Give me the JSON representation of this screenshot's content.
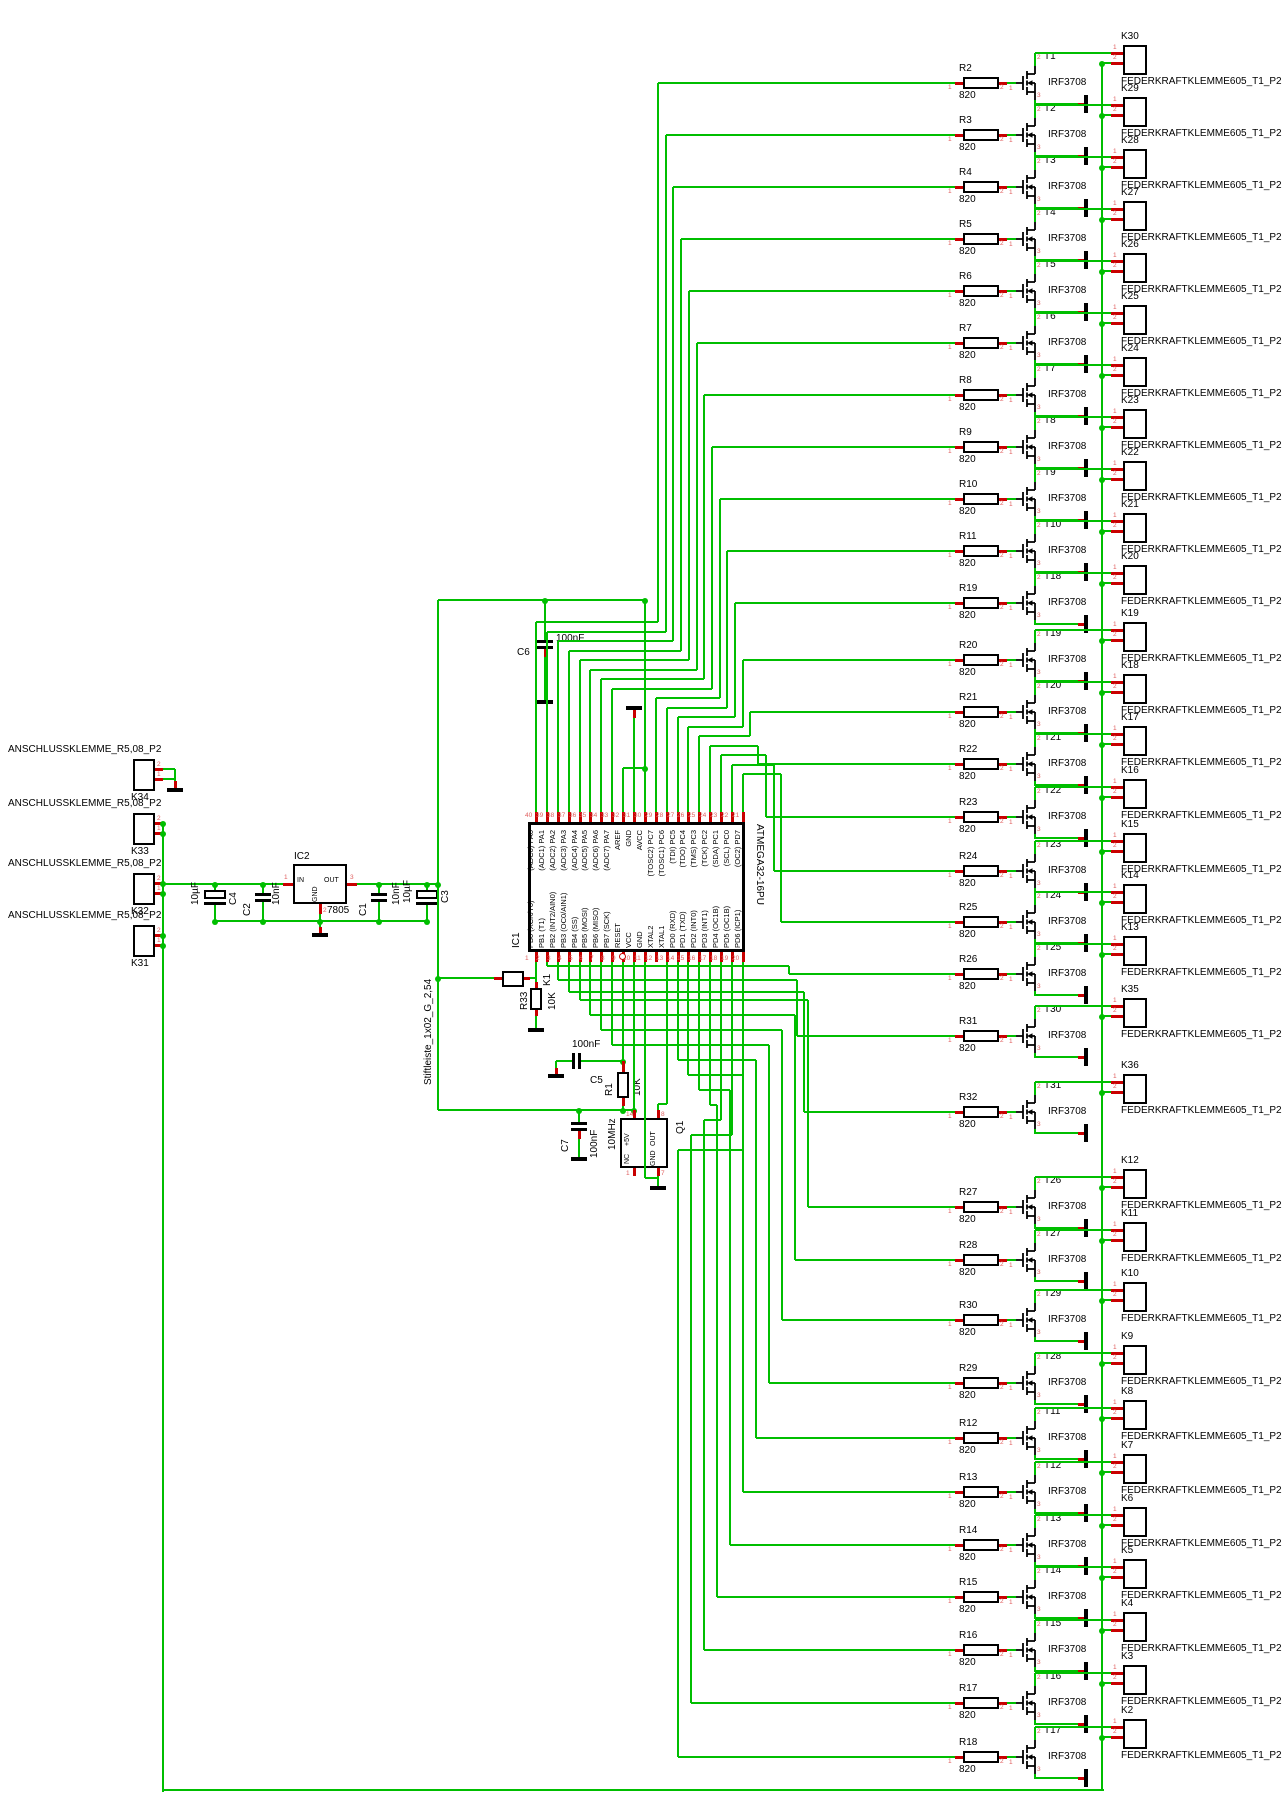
{
  "schematic": {
    "pin_digits": {
      "d1": "1",
      "d2": "2",
      "d3": "3"
    },
    "left_connectors": {
      "package_label": "ANSCHLUSSKLEMME_R5,08_P2",
      "items": [
        "K34",
        "K33",
        "K32",
        "K31"
      ]
    },
    "regulator": {
      "name": "IC2",
      "value": "7805",
      "pin_in": "IN",
      "pin_out": "OUT",
      "pin_gnd": "GND",
      "num_in": "1",
      "num_gnd": "2",
      "num_out": "3"
    },
    "input_caps": [
      {
        "name": "C4",
        "value": "10µF"
      },
      {
        "name": "C2",
        "value": "10nF"
      }
    ],
    "output_caps": [
      {
        "name": "C1",
        "value": "10nF"
      },
      {
        "name": "C3",
        "value": "10µF"
      }
    ],
    "decoupling_cap": {
      "name": "C6",
      "value": "100nF"
    },
    "reset_circuit": {
      "header_name": "K1",
      "header_package": "Stiftleiste_1x02_G_2,54",
      "pulldown_name": "R33",
      "pulldown_value": "10K",
      "cap_name": "C5",
      "cap_value": "100nF",
      "pullup_name": "R1",
      "pullup_value": "10K"
    },
    "oscillator": {
      "name": "Q1",
      "value": "10MHz",
      "cap_name": "C7",
      "cap_value": "100nF",
      "pin_5v": "+5V",
      "pin_out": "OUT",
      "pin_nc": "NC",
      "pin_gnd": "GND",
      "num_5v": "14",
      "num_out": "8",
      "num_nc": "1",
      "num_gnd": "7"
    },
    "mcu": {
      "name": "IC1",
      "part": "ATMEGA32-16PU",
      "top_pins": [
        {
          "n": "40",
          "label": "(ADC0) PA0"
        },
        {
          "n": "39",
          "label": "(ADC1) PA1"
        },
        {
          "n": "38",
          "label": "(ADC2) PA2"
        },
        {
          "n": "37",
          "label": "(ADC3) PA3"
        },
        {
          "n": "36",
          "label": "(ADC4) PA4"
        },
        {
          "n": "35",
          "label": "(ADC5) PA5"
        },
        {
          "n": "34",
          "label": "(ADC6) PA6"
        },
        {
          "n": "33",
          "label": "(ADC7) PA7"
        },
        {
          "n": "32",
          "label": "AREF"
        },
        {
          "n": "31",
          "label": "GND"
        },
        {
          "n": "30",
          "label": "AVCC"
        },
        {
          "n": "29",
          "label": "(TOSC2) PC7"
        },
        {
          "n": "28",
          "label": "(TOSC1) PC6"
        },
        {
          "n": "27",
          "label": "(TDI) PC5"
        },
        {
          "n": "26",
          "label": "(TDO) PC4"
        },
        {
          "n": "25",
          "label": "(TMS) PC3"
        },
        {
          "n": "24",
          "label": "(TCK) PC2"
        },
        {
          "n": "23",
          "label": "(SDA) PC1"
        },
        {
          "n": "22",
          "label": "(SCL) PC0"
        },
        {
          "n": "21",
          "label": "(OC2) PD7"
        }
      ],
      "bottom_pins": [
        {
          "n": "1",
          "label": "PB0 (XCK/T0)"
        },
        {
          "n": "2",
          "label": "PB1 (T1)"
        },
        {
          "n": "3",
          "label": "PB2 (INT2/AIN0)"
        },
        {
          "n": "4",
          "label": "PB3 (OC0/AIN1)"
        },
        {
          "n": "5",
          "label": "PB4 (SS)"
        },
        {
          "n": "6",
          "label": "PB5 (MOSI)"
        },
        {
          "n": "7",
          "label": "PB6 (MISO)"
        },
        {
          "n": "8",
          "label": "PB7 (SCK)"
        },
        {
          "n": "9",
          "label": "RESET"
        },
        {
          "n": "10",
          "label": "VCC"
        },
        {
          "n": "11",
          "label": "GND"
        },
        {
          "n": "12",
          "label": "XTAL2"
        },
        {
          "n": "13",
          "label": "XTAL1"
        },
        {
          "n": "14",
          "label": "PD0 (RXD)"
        },
        {
          "n": "15",
          "label": "PD1 (TXD)"
        },
        {
          "n": "16",
          "label": "PD2 (INT0)"
        },
        {
          "n": "17",
          "label": "PD3 (INT1)"
        },
        {
          "n": "18",
          "label": "PD4 (OC1B)"
        },
        {
          "n": "19",
          "label": "PD5 (OC1B)"
        },
        {
          "n": "20",
          "label": "PD6 (ICP1)"
        }
      ]
    },
    "driver_stages": [
      {
        "transistor": "T1",
        "mosfet": "IRF3708",
        "resistor": "R2",
        "value": "820",
        "terminal": "K30",
        "package": "FEDERKRAFTKLEMME605_T1_P2"
      },
      {
        "transistor": "T2",
        "mosfet": "IRF3708",
        "resistor": "R3",
        "value": "820",
        "terminal": "K29",
        "package": "FEDERKRAFTKLEMME605_T1_P2"
      },
      {
        "transistor": "T3",
        "mosfet": "IRF3708",
        "resistor": "R4",
        "value": "820",
        "terminal": "K28",
        "package": "FEDERKRAFTKLEMME605_T1_P2"
      },
      {
        "transistor": "T4",
        "mosfet": "IRF3708",
        "resistor": "R5",
        "value": "820",
        "terminal": "K27",
        "package": "FEDERKRAFTKLEMME605_T1_P2"
      },
      {
        "transistor": "T5",
        "mosfet": "IRF3708",
        "resistor": "R6",
        "value": "820",
        "terminal": "K26",
        "package": "FEDERKRAFTKLEMME605_T1_P2"
      },
      {
        "transistor": "T6",
        "mosfet": "IRF3708",
        "resistor": "R7",
        "value": "820",
        "terminal": "K25",
        "package": "FEDERKRAFTKLEMME605_T1_P2"
      },
      {
        "transistor": "T7",
        "mosfet": "IRF3708",
        "resistor": "R8",
        "value": "820",
        "terminal": "K24",
        "package": "FEDERKRAFTKLEMME605_T1_P2"
      },
      {
        "transistor": "T8",
        "mosfet": "IRF3708",
        "resistor": "R9",
        "value": "820",
        "terminal": "K23",
        "package": "FEDERKRAFTKLEMME605_T1_P2"
      },
      {
        "transistor": "T9",
        "mosfet": "IRF3708",
        "resistor": "R10",
        "value": "820",
        "terminal": "K22",
        "package": "FEDERKRAFTKLEMME605_T1_P2"
      },
      {
        "transistor": "T10",
        "mosfet": "IRF3708",
        "resistor": "R11",
        "value": "820",
        "terminal": "K21",
        "package": "FEDERKRAFTKLEMME605_T1_P2"
      },
      {
        "transistor": "T18",
        "mosfet": "IRF3708",
        "resistor": "R19",
        "value": "820",
        "terminal": "K20",
        "package": "FEDERKRAFTKLEMME605_T1_P2"
      },
      {
        "transistor": "T19",
        "mosfet": "IRF3708",
        "resistor": "R20",
        "value": "820",
        "terminal": "K19",
        "package": "FEDERKRAFTKLEMME605_T1_P2"
      },
      {
        "transistor": "T20",
        "mosfet": "IRF3708",
        "resistor": "R21",
        "value": "820",
        "terminal": "K18",
        "package": "FEDERKRAFTKLEMME605_T1_P2"
      },
      {
        "transistor": "T21",
        "mosfet": "IRF3708",
        "resistor": "R22",
        "value": "820",
        "terminal": "K17",
        "package": "FEDERKRAFTKLEMME605_T1_P2"
      },
      {
        "transistor": "T22",
        "mosfet": "IRF3708",
        "resistor": "R23",
        "value": "820",
        "terminal": "K16",
        "package": "FEDERKRAFTKLEMME605_T1_P2"
      },
      {
        "transistor": "T23",
        "mosfet": "IRF3708",
        "resistor": "R24",
        "value": "820",
        "terminal": "K15",
        "package": "FEDERKRAFTKLEMME605_T1_P2"
      },
      {
        "transistor": "T24",
        "mosfet": "IRF3708",
        "resistor": "R25",
        "value": "820",
        "terminal": "K14",
        "package": "FEDERKRAFTKLEMME605_T1_P2"
      },
      {
        "transistor": "T25",
        "mosfet": "IRF3708",
        "resistor": "R26",
        "value": "820",
        "terminal": "K13",
        "package": "FEDERKRAFTKLEMME605_T1_P2"
      },
      {
        "transistor": "T30",
        "m osfet": "IRF3708",
        "mosfet": "IRF3708",
        "resistor": "R31",
        "value": "820",
        "terminal": "K35",
        "package": "FEDERKRAFTKLEMME605_T1_P2"
      },
      {
        "transistor": "T31",
        "mosfet": "IRF3708",
        "resistor": "R32",
        "value": "820",
        "terminal": "K36",
        "package": "FEDERKRAFTKLEMME605_T1_P2"
      },
      {
        "transistor": "T26",
        "mosfet": "IRF3708",
        "resistor": "R27",
        "value": "820",
        "terminal": "K12",
        "package": "FEDERKRAFTKLEMME605_T1_P2"
      },
      {
        "transistor": "T27",
        "mosfet": "IRF3708",
        "resistor": "R28",
        "value": "820",
        "terminal": "K11",
        "package": "FEDERKRAFTKLEMME605_T1_P2"
      },
      {
        "transistor": "T29",
        "mosfet": "IRF3708",
        "resistor": "R30",
        "value": "820",
        "terminal": "K10",
        "package": "FEDERKRAFTKLEMME605_T1_P2"
      },
      {
        "transistor": "T28",
        "mosfet": "IRF3708",
        "resistor": "R29",
        "value": "820",
        "terminal": "K9",
        "package": "FEDERKRAFTKLEMME605_T1_P2"
      },
      {
        "transistor": "T11",
        "mosfet": "IRF3708",
        "resistor": "R12",
        "value": "820",
        "terminal": "K8",
        "package": "FEDERKRAFTKLEMME605_T1_P2"
      },
      {
        "transistor": "T12",
        "mosfet": "IRF3708",
        "resistor": "R13",
        "value": "820",
        "terminal": "K7",
        "package": "FEDERKRAFTKLEMME605_T1_P2"
      },
      {
        "transistor": "T13",
        "mosfet": "IRF3708",
        "resistor": "R14",
        "value": "820",
        "terminal": "K6",
        "package": "FEDERKRAFTKLEMME605_T1_P2"
      },
      {
        "transistor": "T14",
        "mosfet": "IRF3708",
        "resistor": "R15",
        "value": "820",
        "terminal": "K5",
        "package": "FEDERKRAFTKLEMME605_T1_P2"
      },
      {
        "transistor": "T15",
        "mosfet": "IRF3708",
        "resistor": "R16",
        "value": "820",
        "terminal": "K4",
        "package": "FEDERKRAFTKLEMME605_T1_P2"
      },
      {
        "transistor": "T16",
        "mosfet": "IRF3708",
        "resistor": "R17",
        "value": "820",
        "terminal": "K3",
        "package": "FEDERKRAFTKLEMME605_T1_P2"
      },
      {
        "transistor": "T17",
        "mosfet": "IRF3708",
        "resistor": "R18",
        "value": "820",
        "terminal": "K2",
        "package": "FEDERKRAFTKLEMME605_T1_P2"
      }
    ]
  }
}
